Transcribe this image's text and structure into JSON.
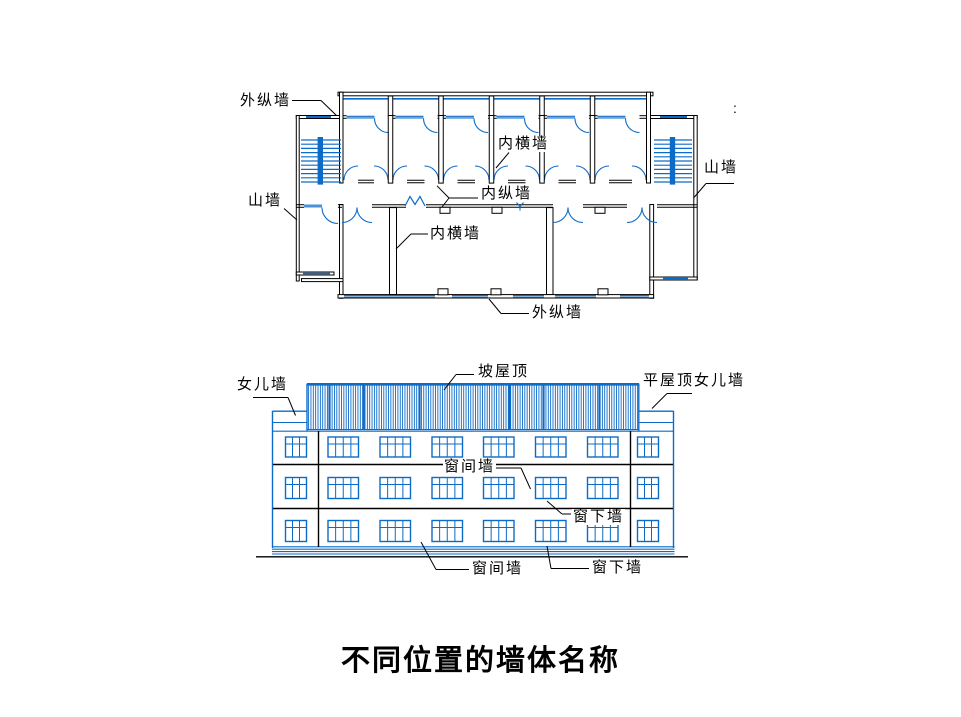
{
  "meta": {
    "background": "#ffffff",
    "line_blue": "#0d6bc8",
    "line_black": "#000000",
    "text_color": "#000000"
  },
  "title": "不同位置的墙体名称",
  "stray_mark": ":",
  "plan_labels": {
    "exterior_longitudinal_top": "外纵墙",
    "interior_transverse_top": "内横墙",
    "gable_left": "山墙",
    "interior_longitudinal": "内纵墙",
    "interior_transverse_bottom": "内横墙",
    "exterior_longitudinal_bottom": "外纵墙",
    "gable_right": "山墙"
  },
  "elevation_labels": {
    "parapet": "女儿墙",
    "pitched_roof": "坡屋顶",
    "flat_roof_parapet": "平屋顶女儿墙",
    "window_pier_middle": "窗间墙",
    "window_sill_middle": "窗下墙",
    "window_pier_bottom": "窗间墙",
    "window_sill_bottom": "窗下墙"
  }
}
